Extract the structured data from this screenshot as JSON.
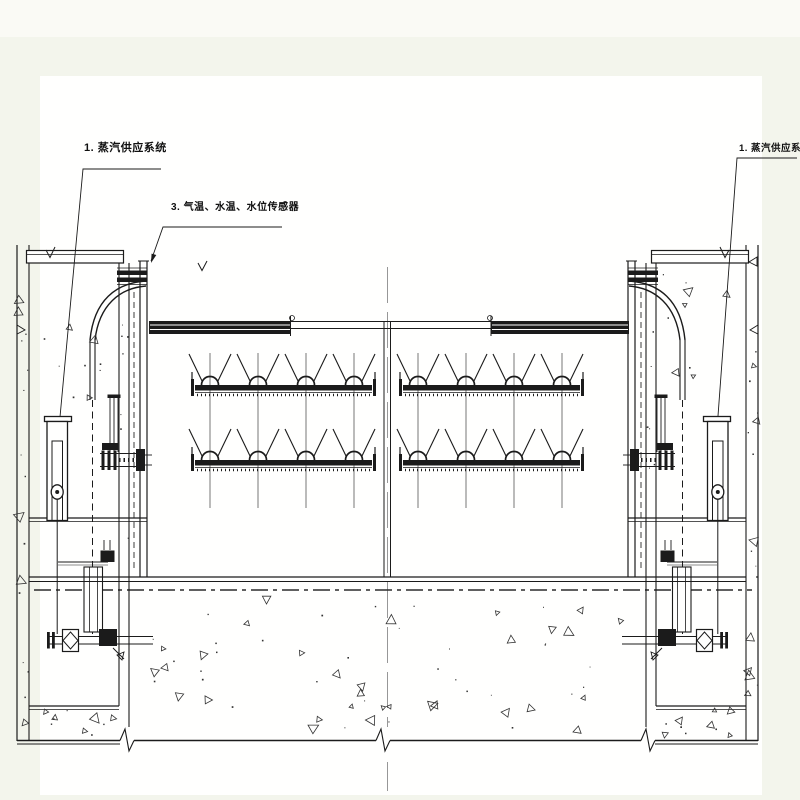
{
  "page": {
    "background": "#f3f5ec",
    "background_top": "#fafaf5",
    "paper": "#fffffe"
  },
  "drawing": {
    "type": "engineering-section-drawing",
    "subject": "gate with steam piping between two concrete piers",
    "colors": {
      "line": "#1b1b1b",
      "centerline": "#979797",
      "concrete_mark": "#333333"
    },
    "callouts": {
      "left_steam": "1. 蒸汽供应系统",
      "sensors": "3. 气温、水温、水位传感器",
      "right_steam": "1. 蒸汽供应系统"
    }
  }
}
